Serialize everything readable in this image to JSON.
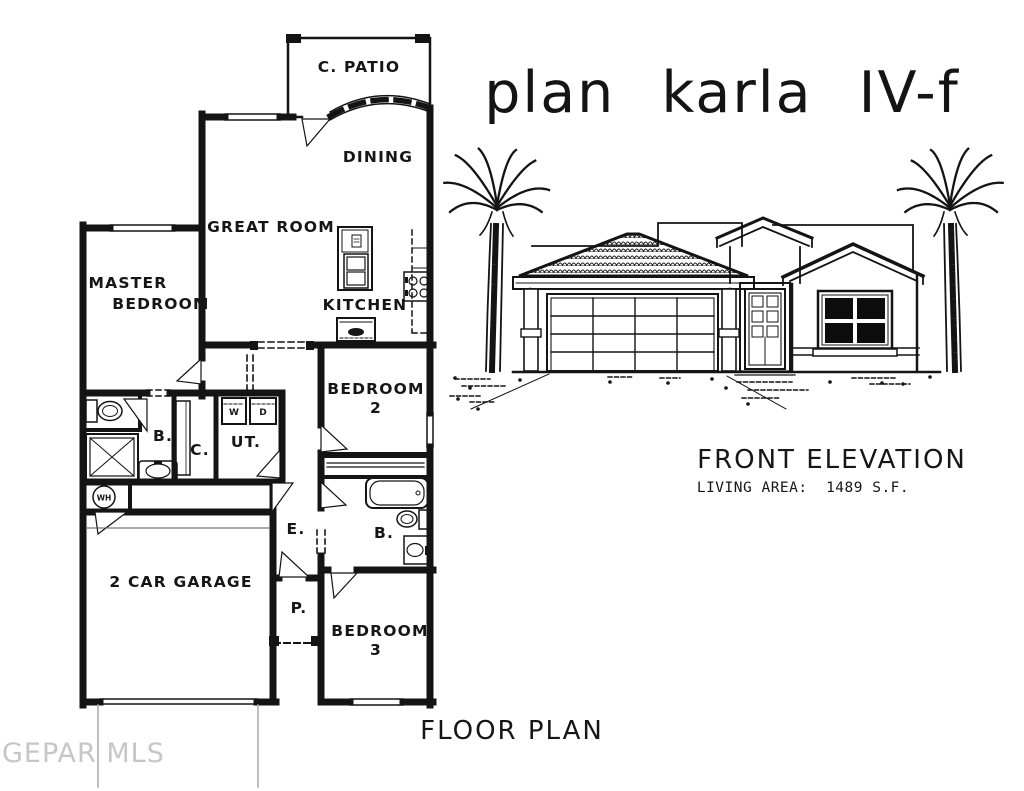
{
  "title": "plan karla IV-f",
  "floor_plan": {
    "caption": "FLOOR PLAN",
    "rooms": {
      "patio": "C. PATIO",
      "dining": "DINING",
      "great_room": "GREAT ROOM",
      "master_line1": "MASTER",
      "master_line2": "BEDROOM",
      "kitchen": "KITCHEN",
      "bedroom2_line1": "BEDROOM",
      "bedroom2_line2": "2",
      "bath_master": "B.",
      "closet": "C.",
      "utility": "UT.",
      "entry": "E.",
      "porch": "P.",
      "garage": "2 CAR GARAGE",
      "bath2": "B.",
      "bedroom3_line1": "BEDROOM",
      "bedroom3_line2": "3"
    },
    "appliances": {
      "washer": "W",
      "dryer": "D",
      "water_heater": "WH"
    }
  },
  "elevation": {
    "caption": "FRONT ELEVATION",
    "living_area": "LIVING AREA:  1489 S.F."
  },
  "watermark": "GEPAR MLS",
  "colors": {
    "line": "#141414",
    "watermark": "#c6c6c6"
  }
}
